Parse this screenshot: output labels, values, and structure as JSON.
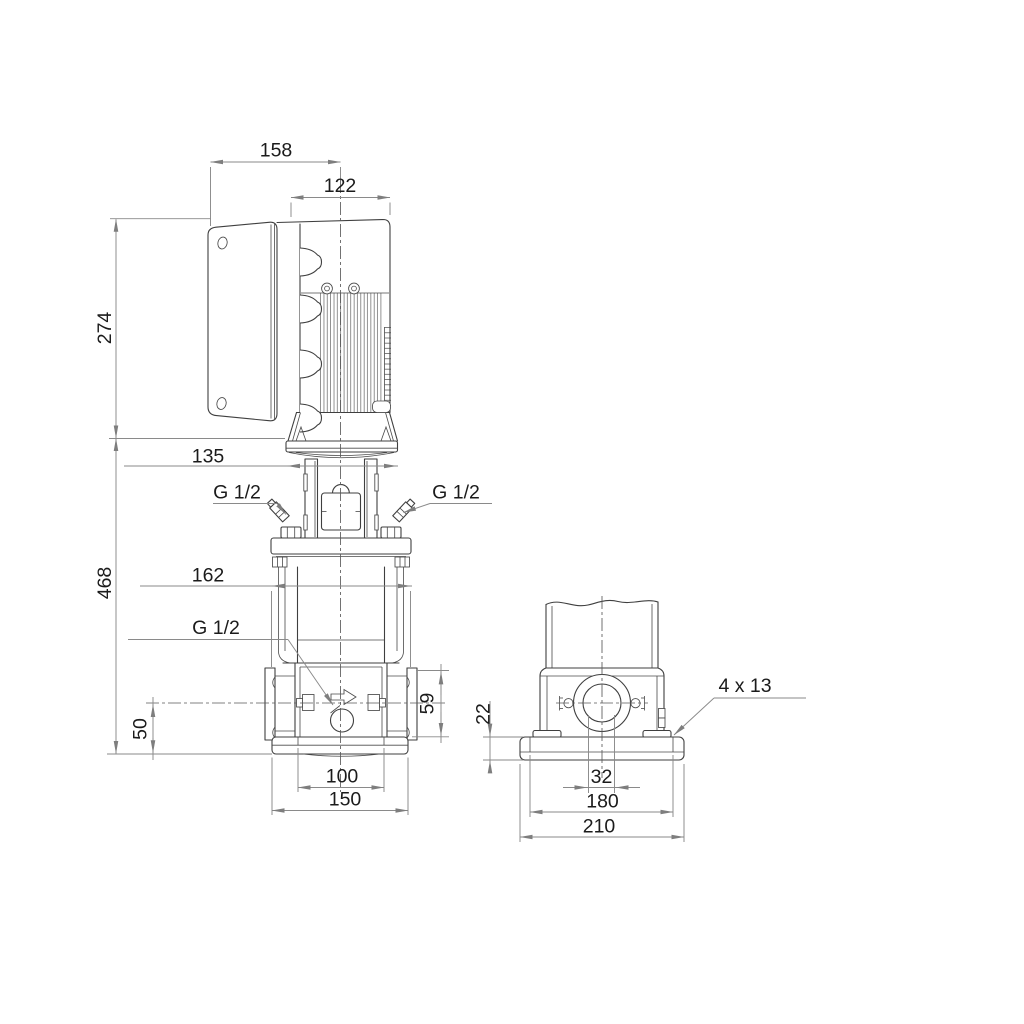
{
  "page": {
    "background": "#ffffff"
  },
  "colors": {
    "outline": "#3f3f3f",
    "dimension_lines": "#8a8a8a",
    "text": "#1b1b1b",
    "centerline": "#5a5a5a"
  },
  "drawing": {
    "type": "pump dimensional outline drawing",
    "views": {
      "front": "front elevation",
      "side": "side elevation"
    }
  },
  "front_view": {
    "dims": {
      "box_to_center": "158",
      "motor_diameter": "122",
      "motor_height": "274",
      "clamp_width": "135",
      "gland_left": "G 1/2",
      "gland_right": "G 1/2",
      "port_to_port": "162",
      "pump_height": "468",
      "drain": "G 1/2",
      "port_center_height": "50",
      "port_zone_height": "59",
      "foot_hole_pitch": "100",
      "base_width": "150"
    }
  },
  "side_view": {
    "dims": {
      "baseplate_height": "22",
      "mounting_holes": "4 x 13",
      "port_bore": "32",
      "bolt_pitch": "180",
      "base_width": "210"
    }
  }
}
